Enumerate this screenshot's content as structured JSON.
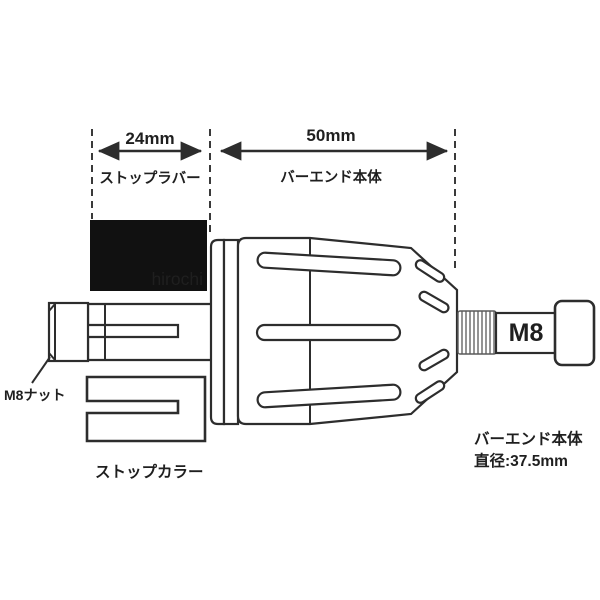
{
  "diagram": {
    "watermark": "hirochi",
    "dimension_annotations": {
      "rubber": {
        "value": "24mm",
        "label": "ストップラバー"
      },
      "body": {
        "value": "50mm",
        "label": "バーエンド本体"
      }
    },
    "part_labels": {
      "nut": "M8ナット",
      "collar": "ストップカラー",
      "bolt_thread": "M8"
    },
    "spec": {
      "name": "バーエンド本体",
      "diameter": "直径:37.5mm"
    },
    "colors": {
      "background": "#ffffff",
      "line": "#2d2d2d",
      "rubber_fill": "#111111",
      "thread_line": "#5a5a5a",
      "watermark_color": "#e3e3e3"
    }
  }
}
